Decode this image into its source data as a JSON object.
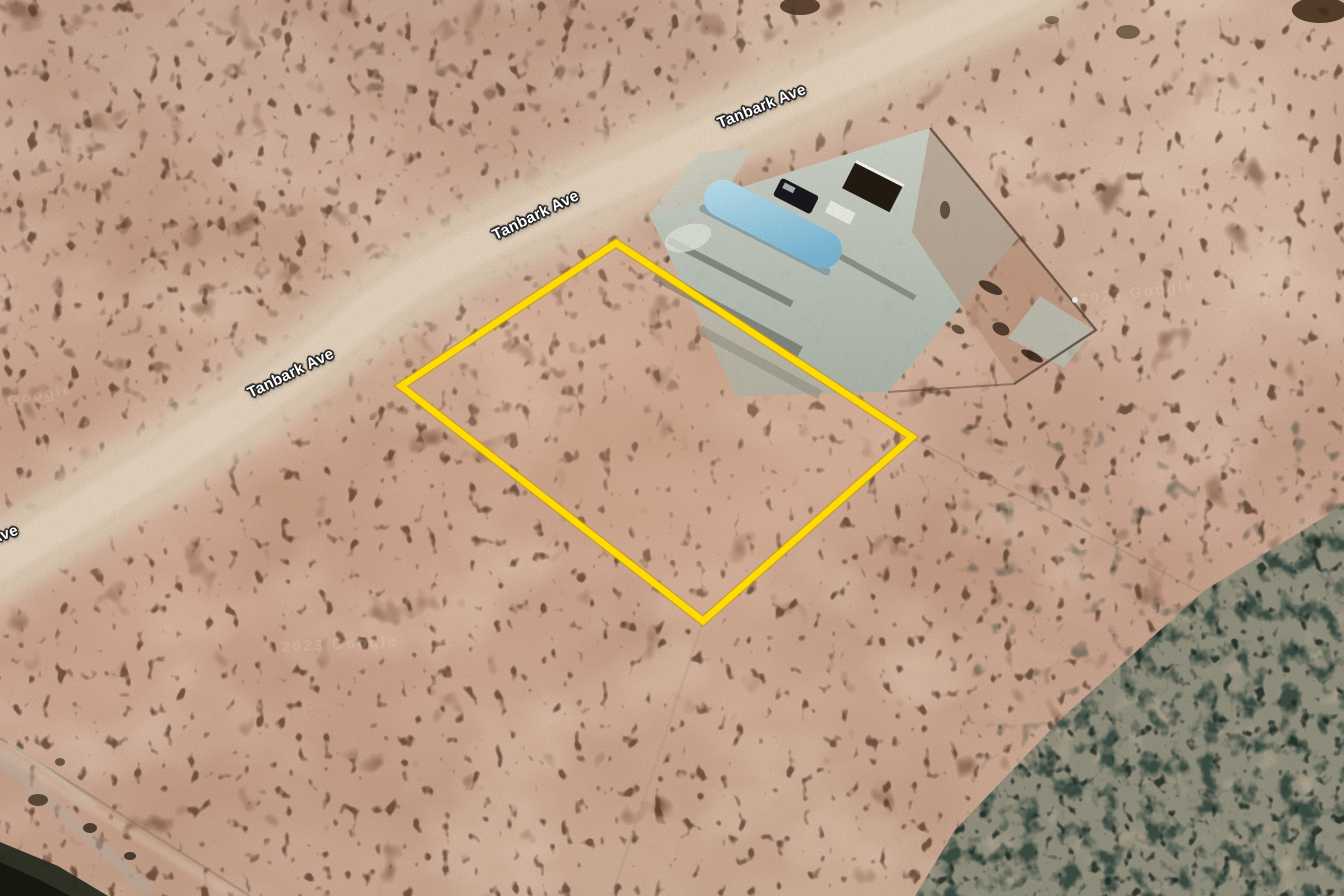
{
  "map": {
    "view": "aerial-satellite-imagery",
    "street": {
      "name": "Tanbark Ave"
    },
    "street_labels": [
      {
        "text": "Tanbark Ave",
        "x": 762,
        "y": 107,
        "rotation": -22
      },
      {
        "text": "Tanbark Ave",
        "x": 536,
        "y": 216,
        "rotation": -26
      },
      {
        "text": "Tanbark Ave",
        "x": 291,
        "y": 374,
        "rotation": -26
      },
      {
        "text": "Tanbark Ave",
        "x": -26,
        "y": 547,
        "rotation": -21
      }
    ],
    "watermarks": [
      {
        "text": "© 2023 Google",
        "x": 330,
        "y": 645,
        "rotation": -3
      },
      {
        "text": "© 2023 Google",
        "x": 6,
        "y": 402,
        "rotation": -11
      },
      {
        "text": "© 2023 Google",
        "x": 1128,
        "y": 294,
        "rotation": -7
      }
    ],
    "parcel_overlay": {
      "label": "highlighted-parcel-boundary",
      "color": "#ffdc00",
      "points_attr": "616,243 912,437 703,621 401,386"
    },
    "road": {
      "path_attr": "M 1060,-30 C 900,50 700,140 536,217 S 380,308 291,375 S 110,492 -40,585"
    },
    "features": {
      "pool_color": "#8fc6dd",
      "pad_color": "#b9c3b8",
      "vegetation_color": "#3c5047",
      "sand_color": "#cfae9b",
      "boundary_color": "#ffdc00"
    }
  }
}
